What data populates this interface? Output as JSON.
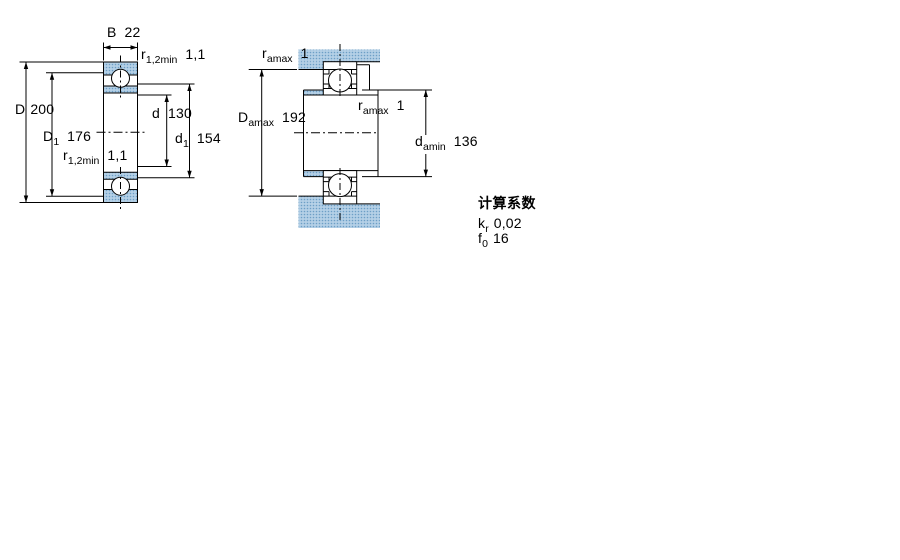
{
  "colors": {
    "steel_fill": "#b4d0e6",
    "steel_dot": "#6d9fc6",
    "line": "#000000"
  },
  "left_drawing": {
    "width_dim": {
      "base": "B",
      "value": "22"
    },
    "radius_top": {
      "base": "r",
      "sub": "1,2min",
      "value": "1,1"
    },
    "outer_diameter": {
      "base": "D",
      "value": "200"
    },
    "shoulder_diameter_D1": {
      "base": "D",
      "sub": "1",
      "value": "176"
    },
    "bore_diameter": {
      "base": "d",
      "value": "130"
    },
    "shoulder_diameter_d1": {
      "base": "d",
      "sub": "1",
      "value": "154"
    },
    "radius_bottom": {
      "base": "r",
      "sub": "1,2min",
      "value": "1,1"
    }
  },
  "right_drawing": {
    "fillet_top": {
      "base": "r",
      "sub": "amax",
      "value": "1"
    },
    "housing_diameter": {
      "base": "D",
      "sub": "amax",
      "value": "192"
    },
    "fillet_mid": {
      "base": "r",
      "sub": "amax",
      "value": "1"
    },
    "shaft_diameter": {
      "base": "d",
      "sub": "amin",
      "value": "136"
    }
  },
  "calculation_factors": {
    "title": "计算系数",
    "rows": [
      {
        "base": "k",
        "sub": "r",
        "value": "0,02"
      },
      {
        "base": "f",
        "sub": "0",
        "value": "16"
      }
    ]
  }
}
